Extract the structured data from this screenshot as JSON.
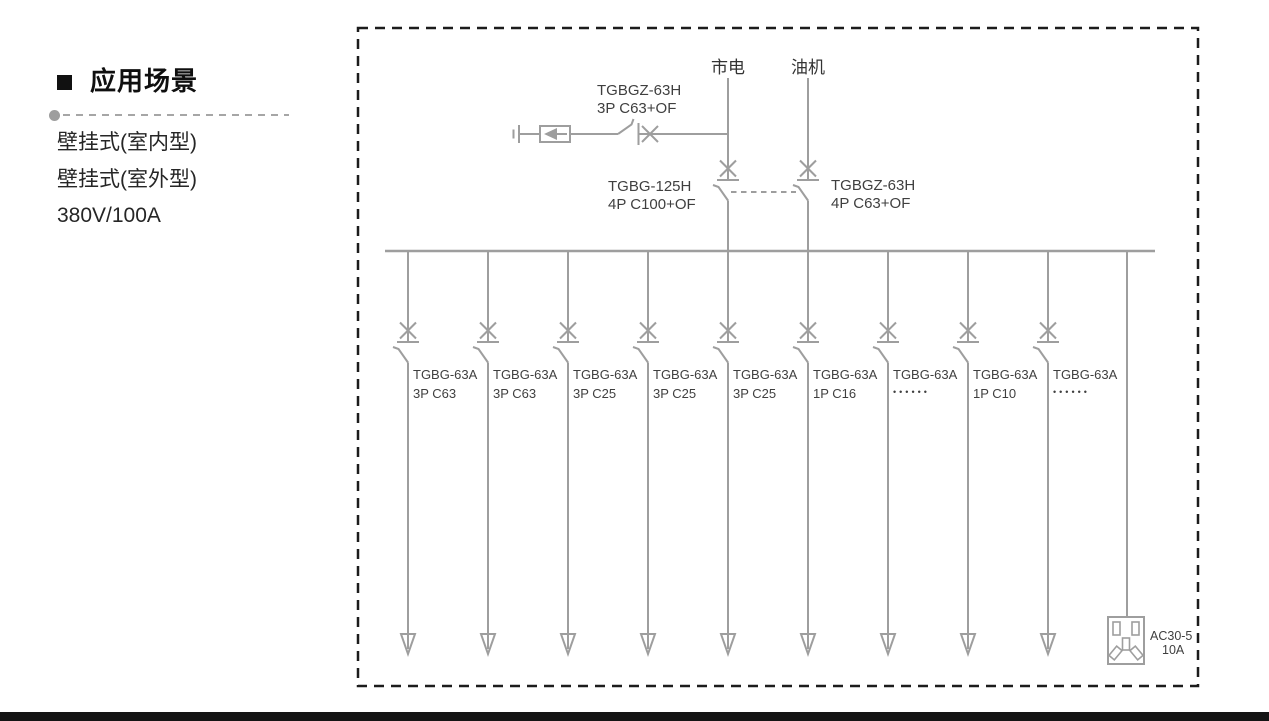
{
  "sidebar": {
    "title": "应用场景",
    "items": [
      "壁挂式(室内型)",
      "壁挂式(室外型)",
      "380V/100A"
    ]
  },
  "diagram": {
    "line_color": "#9e9e9e",
    "text_color": "#3f3f3f",
    "border_color": "#1c1c1c",
    "sources": {
      "mains": "市电",
      "generator": "油机"
    },
    "spd_breaker": {
      "model": "TGBGZ-63H",
      "spec": "3P C63+OF"
    },
    "main_breaker_left": {
      "model": "TGBG-125H",
      "spec": "4P C100+OF"
    },
    "main_breaker_right": {
      "model": "TGBGZ-63H",
      "spec": "4P C63+OF"
    },
    "feeders": [
      {
        "model": "TGBG-63A",
        "spec": "3P C63"
      },
      {
        "model": "TGBG-63A",
        "spec": "3P C63"
      },
      {
        "model": "TGBG-63A",
        "spec": "3P C25"
      },
      {
        "model": "TGBG-63A",
        "spec": "3P C25"
      },
      {
        "model": "TGBG-63A",
        "spec": "3P C25"
      },
      {
        "model": "TGBG-63A",
        "spec": "1P C16"
      },
      {
        "model": "TGBG-63A",
        "spec": "••••••"
      },
      {
        "model": "TGBG-63A",
        "spec": "1P C10"
      },
      {
        "model": "TGBG-63A",
        "spec": "••••••"
      }
    ],
    "socket": {
      "model": "AC30-5",
      "rating": "10A"
    }
  },
  "footer": {
    "bar_color": "#141414"
  }
}
